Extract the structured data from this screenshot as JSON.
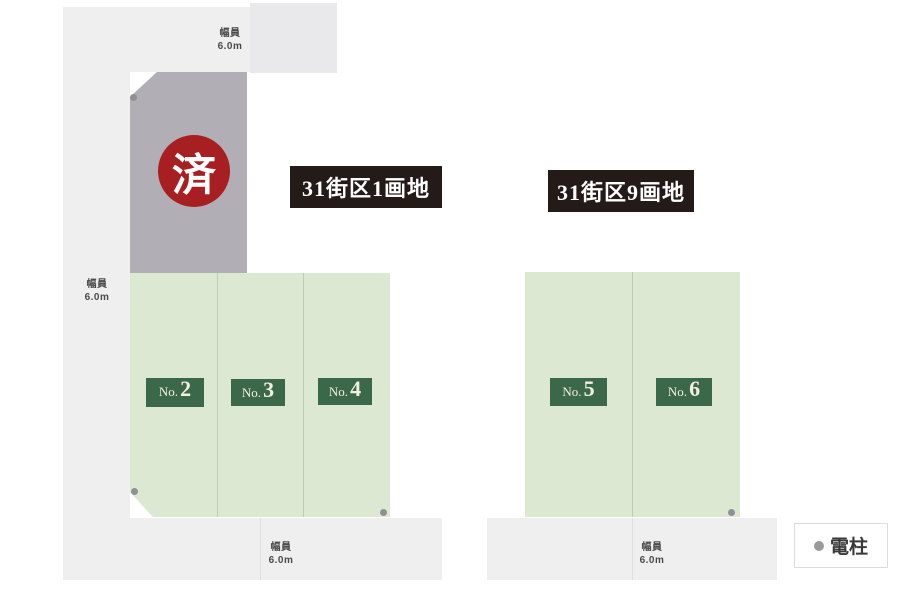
{
  "diagram": {
    "sold_badge": "済",
    "block_labels": {
      "left": "31街区1画地",
      "right": "31街区9画地"
    },
    "road_width_label": {
      "line1": "幅員",
      "line2": "6.0m"
    },
    "lots": [
      {
        "prefix": "No.",
        "number": "2"
      },
      {
        "prefix": "No.",
        "number": "3"
      },
      {
        "prefix": "No.",
        "number": "4"
      },
      {
        "prefix": "No.",
        "number": "5"
      },
      {
        "prefix": "No.",
        "number": "6"
      }
    ],
    "legend": {
      "symbol": "●",
      "label": "電柱"
    },
    "colors": {
      "road": "#efeff0",
      "sold_lot": "#b1aeb5",
      "sold_badge_bg": "#a81f22",
      "available_lot": "#dde8d2",
      "lot_tag_bg": "#3c684a",
      "lot_tag_text": "#f3efdf",
      "block_label_bg": "#241a18",
      "pole_dot": "#909094"
    }
  }
}
